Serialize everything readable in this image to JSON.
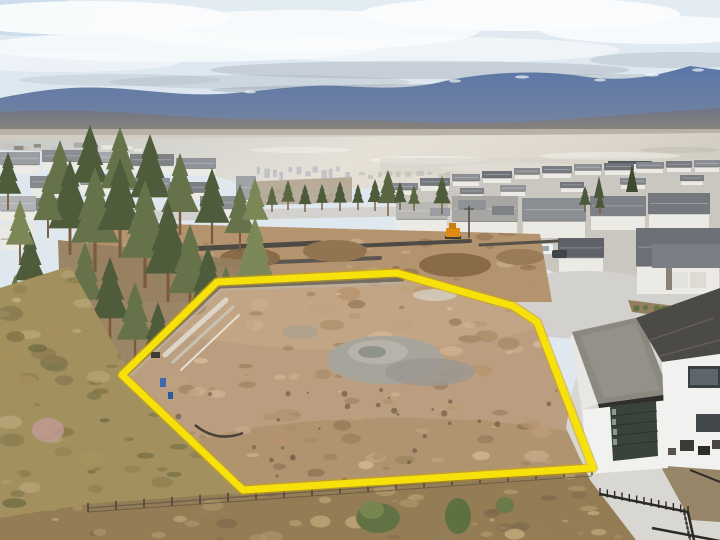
{
  "image": {
    "kind": "aerial-drone-photograph",
    "subject": "vacant graded building lot outlined in yellow above a lakeside residential subdivision",
    "width_px": 720,
    "height_px": 540
  },
  "overlay": {
    "boundary_points": "122,375 217,282 397,273 513,306 537,322 593,468 243,490",
    "boundary_color": "#f6e10a",
    "boundary_under_color": "#cda50a",
    "boundary_width": "7"
  },
  "colors": {
    "sky_patch": "#c3d7e9",
    "cloud_white": "#fafcfd",
    "cloud_gray": "#a9b2bb",
    "mountain": "#5e79a8",
    "mountain_right": "#50668e",
    "slope": "#95876f",
    "haze": "#ccc6bb",
    "lake_left": "#c6c9c8",
    "lake_bright": "#e6e1d7",
    "lake_right": "#d3cec2",
    "shore_town": "#b2a692",
    "road": "#d2d1cd",
    "mid_dirt": "#b3946f",
    "retaining_wall": "#4e4a44",
    "lot_base": "#bb9e7f",
    "gravel_pile": "#a7a49b",
    "forest_dark": "#4f5c3b",
    "forest_mid": "#66734a",
    "forest_light": "#7c8757",
    "trunk": "#7b5b3b",
    "hillside": "#a3905f",
    "bottom_strip": "#947c55",
    "bush_pink": "#c09a93",
    "shrub_green": "#637244",
    "fence_rail": "#6b5f4e",
    "fence_post": "#4a4238",
    "railing_black": "#2c2a27",
    "house_wall": "#f1f1ef",
    "flat_roof": "#8b8880",
    "roof_fascia": "#2f2e2b",
    "main_roof": "#4c4a46",
    "garage_door": "#39423b",
    "driveway": "#d9d7d2",
    "excavator_orange": "#e08a12",
    "vehicle_white": "#f0f0ee",
    "vehicle_dark": "#41454a",
    "bed_soil": "#94805f",
    "distant_city": "#b8bcc2",
    "lakeshore_building": "#e9e8e4"
  }
}
